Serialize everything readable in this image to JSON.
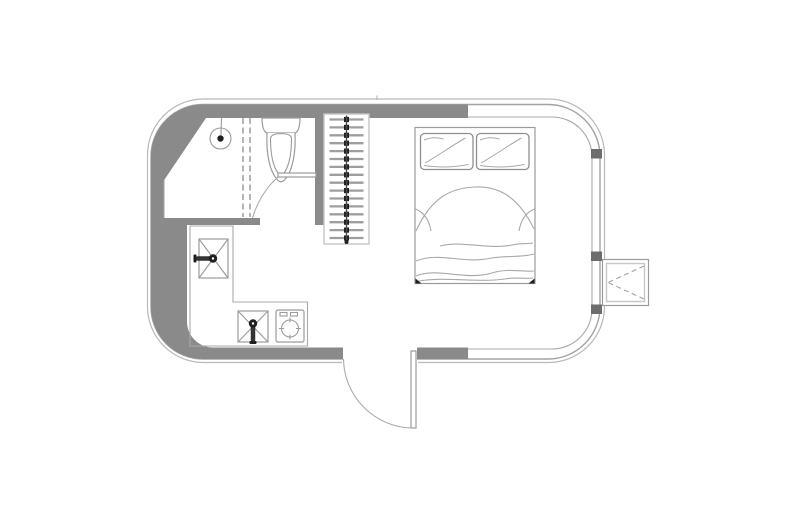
{
  "canvas": {
    "width": 800,
    "height": 526,
    "background": "#ffffff"
  },
  "palette": {
    "wall": "#8a8a8a",
    "body_outline": "#b9b9b9",
    "shell_outline": "#a3a3a3",
    "fixture_outline": "#9b9b9b",
    "light_outline": "#c6c6c6",
    "hanger_bar": "#9e9e9e",
    "hardware_dark": "#1f1f1f",
    "window_post": "#6d6d6d",
    "door_arc": "#ababab"
  },
  "plan": {
    "type": "floor-plan",
    "layout": "rounded-camper-tiny-home",
    "rooms": [
      {
        "name": "bathroom",
        "fixtures": [
          "shower-head",
          "shower-screen",
          "toilet",
          "bathroom-door"
        ]
      },
      {
        "name": "closet",
        "fixtures": [
          "hanging-rail",
          "hangers"
        ]
      },
      {
        "name": "kitchen",
        "fixtures": [
          "l-shaped-counter",
          "utility-sink",
          "kitchen-sink",
          "cooktop"
        ]
      },
      {
        "name": "sleeping-area",
        "fixtures": [
          "double-bed",
          "pillows",
          "blanket"
        ]
      }
    ],
    "doors": [
      {
        "name": "entry-door",
        "location": "bottom-wall",
        "swing": "outward"
      },
      {
        "name": "bathroom-door",
        "location": "interior-wall",
        "swing": "inward"
      }
    ],
    "closet": {
      "hanger_count": 16,
      "rail_x": 346.5,
      "bar_x1": 329.5,
      "bar_x2": 363.5,
      "top_y": 119.5,
      "step_y": 7.9
    },
    "bed": {
      "pillow_count": 2,
      "blanket_wave_count": 4
    },
    "exterior": {
      "step_platform": true,
      "window_posts": [
        {
          "y": 149
        },
        {
          "y": 251.5
        },
        {
          "y": 304.5
        }
      ]
    }
  }
}
